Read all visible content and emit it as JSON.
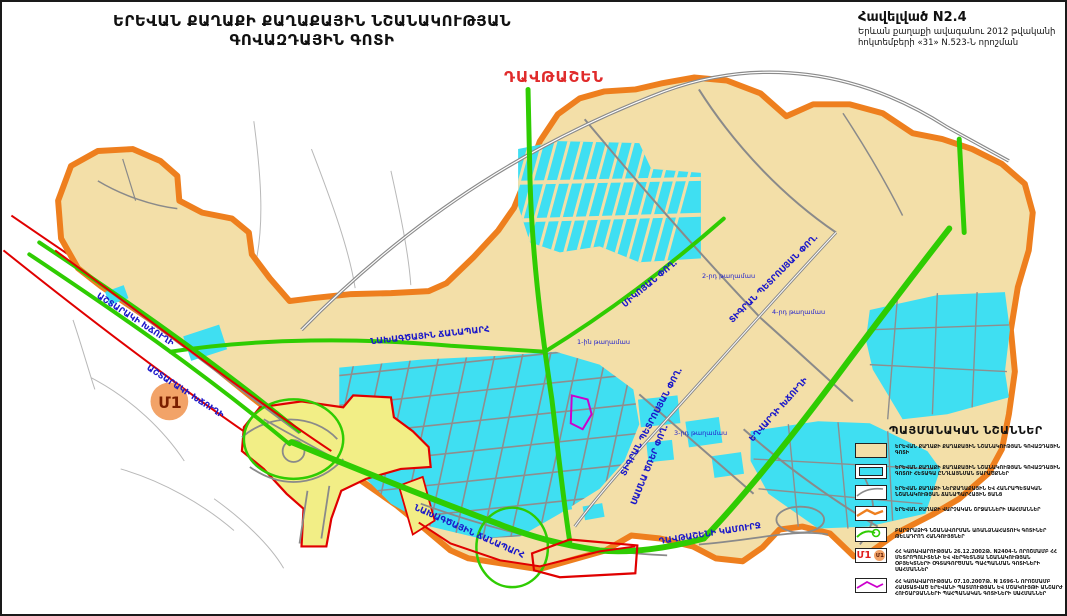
{
  "title": {
    "line1": "ԵՐԵՎԱՆ ՔԱՂԱՔԻ ՔԱՂԱՔԱՅԻՆ ՆՇԱՆԱԿՈՒԹՅԱՆ",
    "line2": "ԳՈՎԱԶԴԱՅԻՆ ԳՈՏԻ"
  },
  "annex": {
    "line1": "Հավելված N2.4",
    "line2": "Երևան քաղաքի ավագանու 2012 թվականի",
    "line3": "հոկտեմբերի «31» N.523-Ն որոշման"
  },
  "district_label": "ԴԱՎԹԱՇԵՆ",
  "metro_marker": "Մ1",
  "map_labels": {
    "ashtarak_1": "ԱՇՏԱՐԱԿԻ ԽՃՈՒՂԻ",
    "ashtarak_2": "ԱՇՏԱՐԱԿԻ ԽՃՈՒՂԻ",
    "projected_road_1": "ՆԱԽԱԳԾԱՅԻՆ ՃԱՆԱՊԱՐՀ",
    "projected_road_2": "ՆԱԽԱԳԾԱՅԻՆ ՃԱՆԱՊԱՐՀ",
    "davtashen_bridge": "ԴԱՎԹԱՇԵՆԻ ԿԱՄՈՒՐՋ",
    "tigran_petrosyan_1": "ՏԻԳՐԱՆ ՊԵՏՐՈՍՅԱՆ ՓՈՂ.",
    "tigran_petrosyan_2": "ՏԻԳՐԱՆ ՊԵՏՐՈՍՅԱՆ ՓՈՂ.",
    "mikoyan": "ՄԻԿՈՅԱՆ ՓՈՂ.",
    "yeghvard": "ԵՂՎԱՐԴԻ ԽՃՈՒՂԻ",
    "sasna_tsrer": "ՍԱՍՆԱ ԾՌԵՐ ՓՈՂ."
  },
  "quarters": {
    "q1": "1-ին թաղամաս",
    "q2": "2-րդ թաղամաս",
    "q3": "3-րդ թաղամաս",
    "q4": "4-րդ թաղամաս"
  },
  "legend": {
    "header": "ՊԱՅՄԱՆԱԿԱՆ ՆՇԱՆՆԵՐ",
    "items": [
      {
        "text": "ԵՐԵՎԱՆ ՔԱՂԱՔԻ ՔԱՂԱՔԱՅԻՆ ՆՇԱՆԱԿՈՒԹՅԱՆ ԳՈՎԱԶԴԱՅԻՆ ԳՈՏԻ"
      },
      {
        "text": "ԵՐԵՎԱՆ ՔԱՂԱՔԻ ՔԱՂԱՔԱՅԻՆ ՆՇԱՆԱԿՈՒԹՅԱՆ ԳՈՎԱԶԴԱՅԻՆ ԳՈՏՈՒ ՀԵՏԱԳԱ ԸՆԴԼԱՅՆՄԱՆ ՏԱՐԱԾՔՆԵՐ"
      },
      {
        "text": "ԵՐԵՎԱՆ ՔԱՂԱՔԻ ՆԵՐՔԱՂԱՔԱՅԻՆ ԵՎ ՀԱՆՐԱՊԵՏԱԿԱՆ ՆՇԱՆԱԿՈՒԹՅԱՆ ՃԱՆԱՊԱՐՀԱՅԻՆ ՑԱՆՑ"
      },
      {
        "text": "ԵՐԵՎԱՆ ՔԱՂԱՔԻ ՎԱՐՉԱԿԱՆ ՇՐՋԱՆՆԵՐԻ ՍԱՀՄԱՆՆԵՐ"
      },
      {
        "text": "ԲԱՐՁՐԱՁԻԳ ՆՇԱՆԱՎՈՐՄԱՆ ԱՌԱՆՁՆԱՀԱՏՈՒԿ ԳՈՏԻՆԵՐ ԹԵԼԱԴՐՈՂ ՀԱՆԳՈՒՅՑՆԵՐ"
      },
      {
        "text": "ՀՀ ԿԱՌԱՎԱՐՈՒԹՅԱՆ 26.12.2002Թ. N2404-Ն ՈՐՈՇՄԱՄԲ ՀՀ ՄԵՏՐՈՊՈԼԻՏԵՆԻ ԵՎ ՎԵՐԳԵՏՆՅԱ ՆՇԱՆԱԿՈՒԹՅԱՆ ՕԲՅԵԿՏՆԵՐԻ ՕԳՏԱԳՈՐԾՄԱՆ ՊԱՀՊԱՆՄԱՆ ԳՈՏԻՆԵՐԻ ՍԱՀՄԱՆՆԵՐ"
      },
      {
        "text": "ՀՀ ԿԱՌԱՎԱՐՈՒԹՅԱՆ 07.10.2007Թ. N 1696-Ն ՈՐՈՇՄԱՄԲ ՀԱՍՏԱՏՎԱԾ ԵՐԵՎԱՆԻ ՊԱՏՄՈՒԹՅԱՆ ԵՎ ՄՇԱԿՈՒՅԹԻ ԱՆՇԱՐԺ ՀՈՒՇԱՐՁԱՆՆԵՐԻ ՊԱՀՊԱՆԱԿԱՆ ԳՈՏԻՆԵՐԻ ՍԱՀՄԱՆՆԵՐ"
      }
    ]
  },
  "colors": {
    "zone_fill": "#f3dfa8",
    "district_border": "#ee7f1e",
    "expansion_fill": "#3fdff2",
    "main_road_green": "#2fcc02",
    "restriction_red": "#e00000",
    "road_gray": "#8a8a8a",
    "street_label_blue": "#1b18c9",
    "monument_magenta": "#cc00cc",
    "metro_circle": "#f2a368"
  }
}
